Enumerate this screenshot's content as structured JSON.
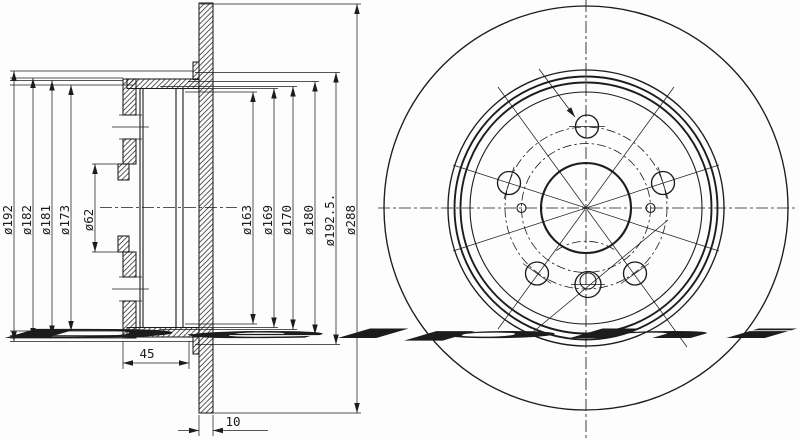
{
  "watermark": {
    "text": "Delphi",
    "color": "#dbe3f0"
  },
  "colors": {
    "line": "#1c1c1c",
    "background": "#fdfdfd"
  },
  "section_view": {
    "left_diameters": [
      "ø192",
      "ø182",
      "ø181",
      "ø173",
      "ø62"
    ],
    "right_diameters": [
      "ø163",
      "ø169",
      "ø170",
      "ø180",
      "ø192.5.",
      "ø288"
    ],
    "hat_depth": "45",
    "thickness": "10"
  }
}
